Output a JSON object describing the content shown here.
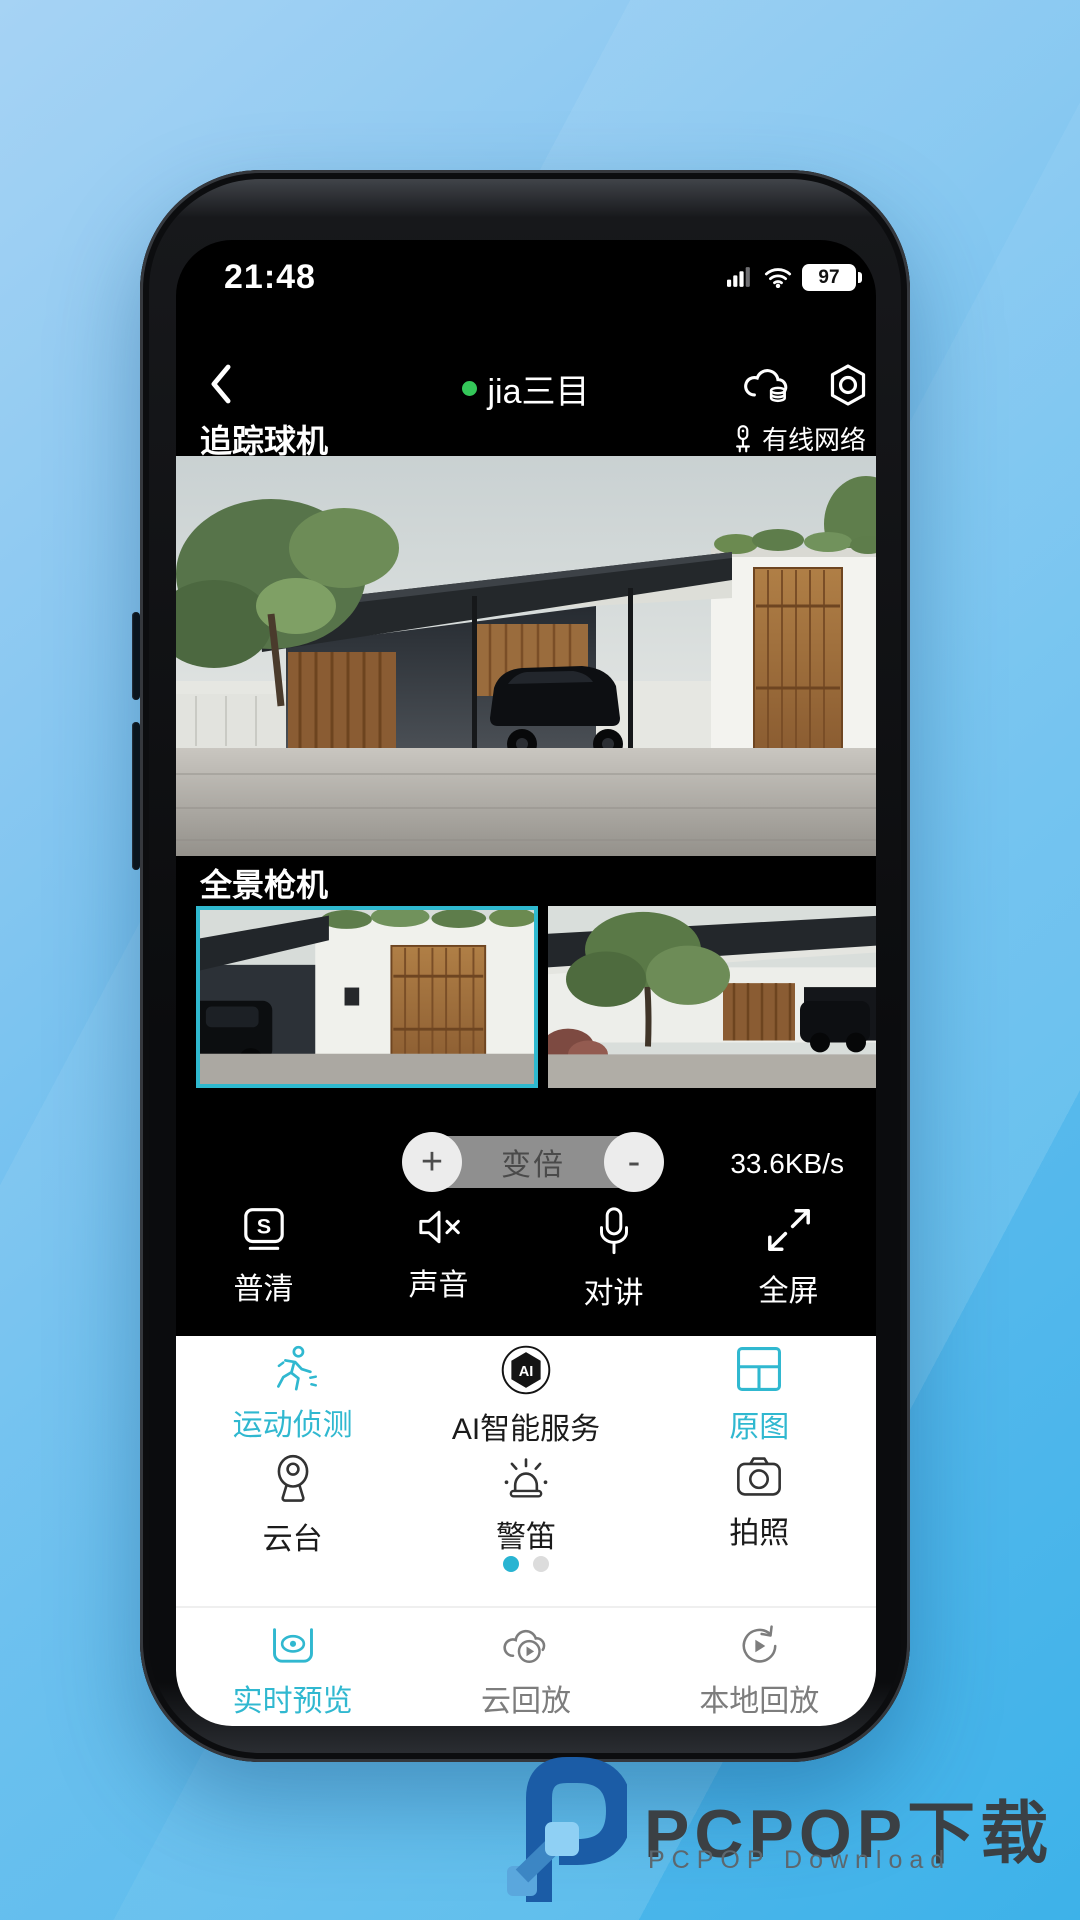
{
  "status_bar": {
    "time": "21:48",
    "battery_percent": "97"
  },
  "nav_bar": {
    "device_name": "jia三目"
  },
  "tracking_camera": {
    "label": "追踪球机",
    "network_status": "有线网络"
  },
  "panorama_camera": {
    "label": "全景枪机"
  },
  "zoom_control": {
    "plus": "+",
    "minus": "-",
    "label": "变倍",
    "bitrate": "33.6KB/s"
  },
  "toolbar": {
    "items": [
      {
        "label": "普清",
        "glyph": "S"
      },
      {
        "label": "声音"
      },
      {
        "label": "对讲"
      },
      {
        "label": "全屏"
      }
    ]
  },
  "features": {
    "row1": [
      {
        "label": "运动侦测"
      },
      {
        "label": "AI智能服务",
        "badge": "AI"
      },
      {
        "label": "原图"
      }
    ],
    "row2": [
      {
        "label": "云台"
      },
      {
        "label": "警笛"
      },
      {
        "label": "拍照"
      }
    ]
  },
  "tab_bar": {
    "items": [
      {
        "label": "实时预览"
      },
      {
        "label": "云回放"
      },
      {
        "label": "本地回放"
      }
    ]
  },
  "watermark": {
    "title": "PCPOP下载",
    "subtitle": "PCPOP Download"
  },
  "colors": {
    "accent_teal": "#30b8d0",
    "online_green": "#34c759",
    "thumb_border": "#2fb9cf",
    "inactive_gray": "#7d7d7d"
  }
}
